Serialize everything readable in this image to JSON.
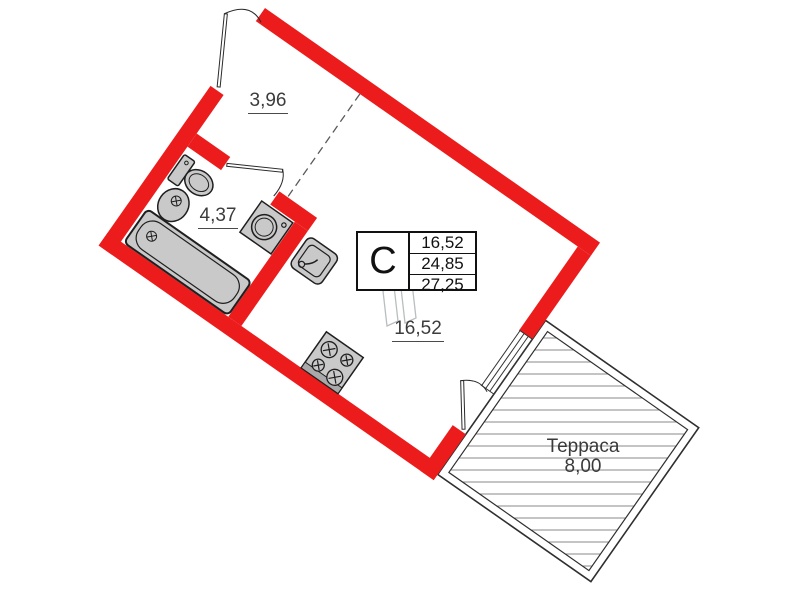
{
  "unit": {
    "type_label": "С",
    "area_rows": [
      "16,52",
      "24,85",
      "27,25"
    ]
  },
  "rooms": {
    "hallway": {
      "area": "3,96"
    },
    "bathroom": {
      "area": "4,37"
    },
    "main_room": {
      "area": "16,52"
    },
    "terrace": {
      "name": "Терраса",
      "area": "8,00"
    }
  },
  "colors": {
    "walls": "#ed1c1c",
    "fixtures_fill": "#c9c9c9",
    "fixture_stroke": "#1f1f1f",
    "labels_text": "#3c3c3c",
    "table_text": "#111111",
    "hatch": "#8a8a8a"
  }
}
